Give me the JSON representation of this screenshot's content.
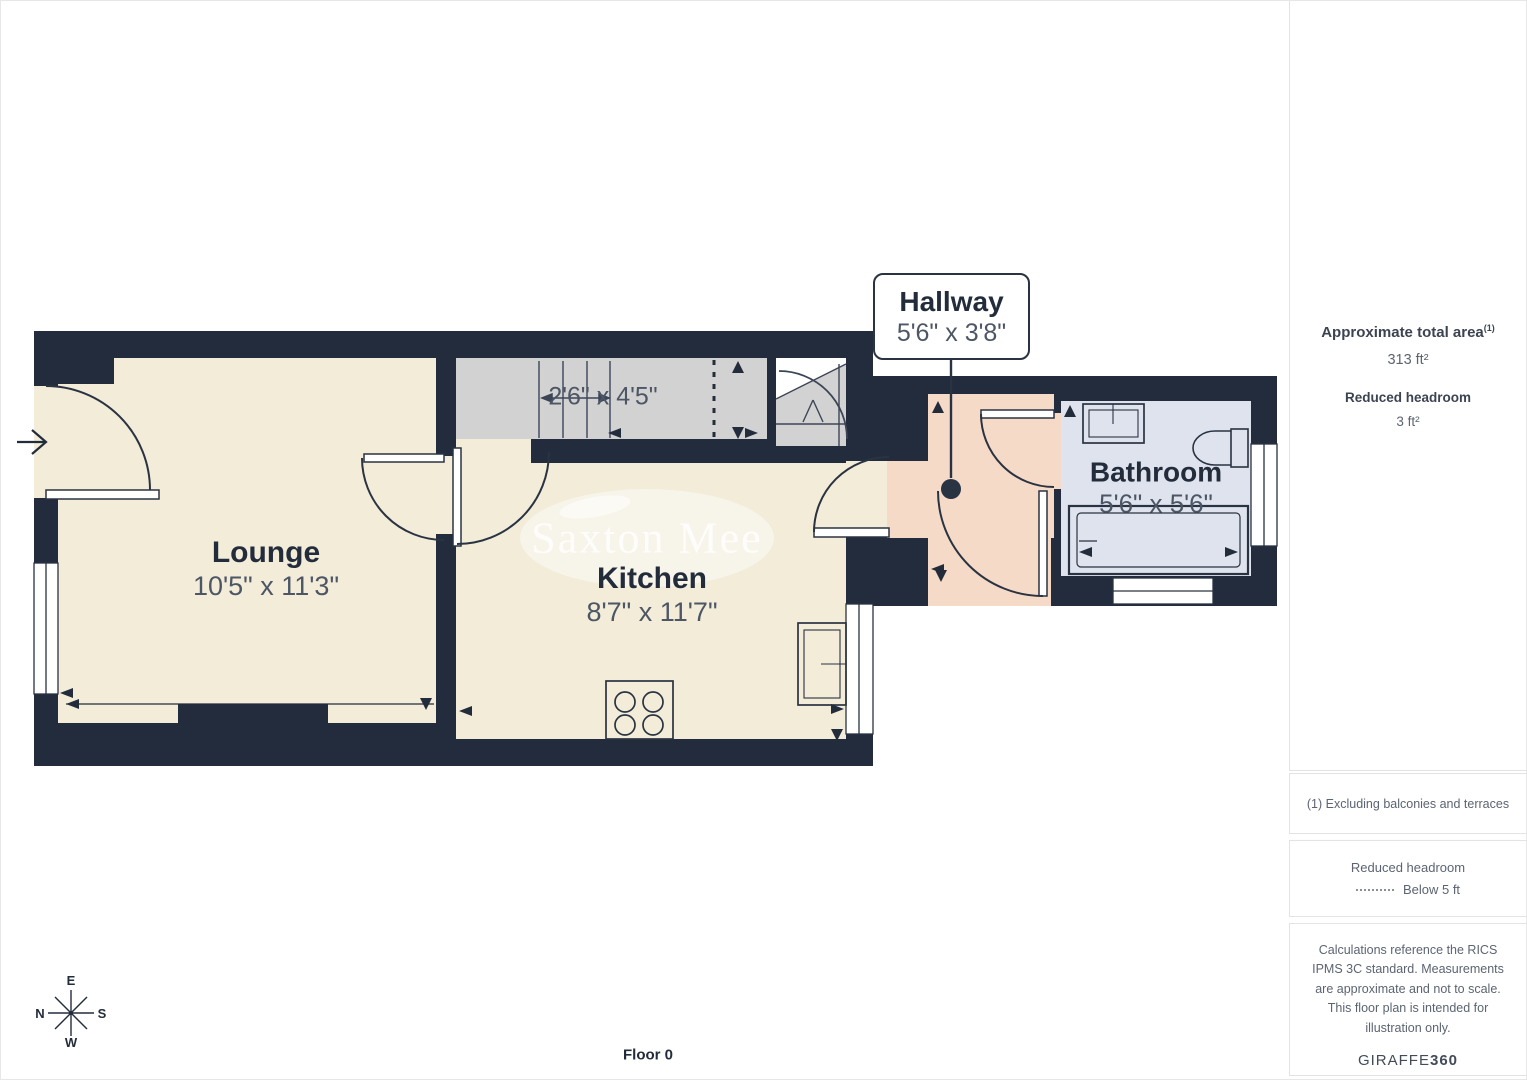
{
  "floorplan": {
    "floor_label": "Floor 0",
    "watermark": "Saxton Mee",
    "rooms": {
      "lounge": {
        "name": "Lounge",
        "dimensions": "10'5\" x 11'3\""
      },
      "kitchen": {
        "name": "Kitchen",
        "dimensions": "8'7\" x 11'7\""
      },
      "bathroom": {
        "name": "Bathroom",
        "dimensions": "5'6\" x 5'6\""
      },
      "stairs": {
        "dimensions": "2'6\" x 4'5\""
      }
    },
    "callout": {
      "room": "Hallway",
      "dimensions": "5'6\" x 3'8\""
    },
    "compass": {
      "top": "E",
      "right": "S",
      "bottom": "W",
      "left": "N"
    },
    "colors": {
      "wall": "#222C3C",
      "floor": "#F2ECD9",
      "stairs": "#D2D2D2",
      "hallway": "#F6DAC8",
      "bathroom": "#DFE3EE"
    }
  },
  "sidebar": {
    "total_area": {
      "label": "Approximate total area",
      "footnote_marker": "(1)",
      "value": "313 ft²"
    },
    "reduced_headroom": {
      "label": "Reduced headroom",
      "value": "3 ft²"
    },
    "footnote": "(1) Excluding balconies and terraces",
    "legend": {
      "title": "Reduced headroom",
      "item_label": "Below 5 ft"
    },
    "disclaimer": "Calculations reference the RICS IPMS 3C standard. Measurements are approximate and not to scale. This floor plan is intended for illustration only.",
    "brand": {
      "name": "GIRAFFE",
      "bold": "360"
    }
  }
}
